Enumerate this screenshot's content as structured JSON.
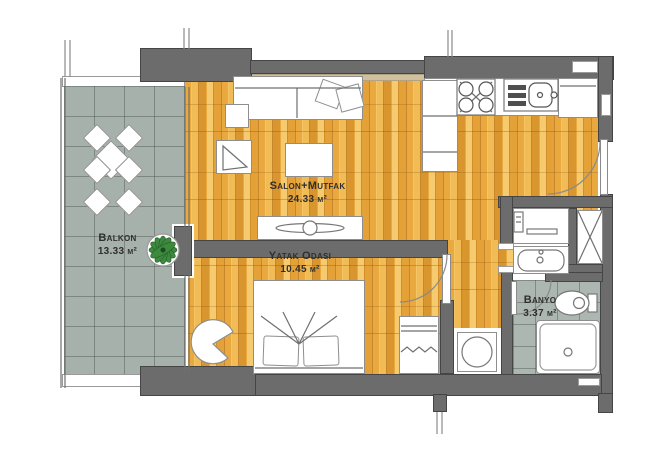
{
  "plan": {
    "type": "apartment-floor-plan",
    "rooms": {
      "balkon": {
        "label": "Balkon",
        "area": "13.33 m²"
      },
      "salon_mutfak": {
        "label": "Salon+Mutfak",
        "area": "24.33 m²"
      },
      "yatak_odasi": {
        "label": "Yatak Odası",
        "area": "10.45 m²"
      },
      "banyo": {
        "label": "Banyo",
        "area": "3.37 m²"
      }
    },
    "fixtures": [
      "sofa",
      "sofa-cushions",
      "side-table",
      "armchair",
      "coffee-table",
      "tv-console",
      "tv",
      "kitchen-counter",
      "kitchen-cabinet",
      "stove",
      "kitchen-sink",
      "fridge",
      "entrance-door",
      "double-bed",
      "bed-pillows",
      "bedroom-chair",
      "wardrobe",
      "washing-machine",
      "shower",
      "vanity-sink",
      "toilet",
      "bathtub",
      "utility-shaft",
      "balcony-table-set",
      "potted-plant",
      "sliding-glass-door"
    ],
    "colors": {
      "wall": "#6c6c6c",
      "wood_floor": "#e8a93c",
      "tile_floor": "#a7b1ab",
      "fixture_fill": "#ffffff",
      "plant_green": "#3c8a3e",
      "label_text": "#2f2f2f"
    }
  }
}
